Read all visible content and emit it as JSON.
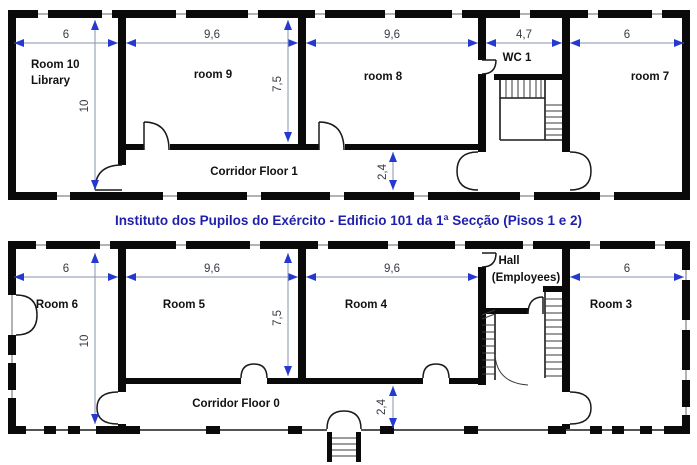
{
  "title": "Instituto dos Pupilos do Exército - Edificio 101 da 1ª Secção (Pisos 1 e 2)",
  "colors": {
    "wall": "#0a0a0a",
    "dimension_line": "#8a93ad",
    "dimension_arrow": "#2538cf",
    "dimension_text": "#3a3a44",
    "room_label_text": "#111111",
    "title_text": "#1f1fad",
    "background": "#ffffff"
  },
  "floor1": {
    "name": "Floor 1",
    "labels": {
      "room10_line1": "Room 10",
      "room10_line2": "Library",
      "room9": "room 9",
      "room8": "room 8",
      "wc1": "WC 1",
      "room7": "room 7",
      "corridor": "Corridor Floor 1"
    },
    "dimensions": {
      "left_width": "6",
      "room9_width": "9,6",
      "room8_width": "9,6",
      "wc_width": "4,7",
      "right_width": "6",
      "height": "10",
      "room_depth": "7,5",
      "corridor_depth": "2,4"
    }
  },
  "floor0": {
    "name": "Floor 0",
    "labels": {
      "room6": "Room 6",
      "room5": "Room 5",
      "room4": "Room 4",
      "hall_line1": "Hall",
      "hall_line2": "(Employees)",
      "room3": "Room 3",
      "corridor": "Corridor Floor 0"
    },
    "dimensions": {
      "left_width": "6",
      "room5_width": "9,6",
      "room4_width": "9,6",
      "right_width": "6",
      "height": "10",
      "room_depth": "7,5",
      "corridor_depth": "2,4"
    }
  }
}
